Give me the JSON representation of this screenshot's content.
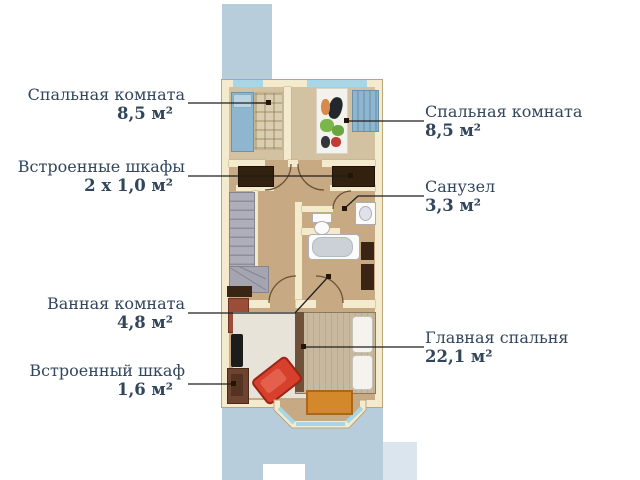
{
  "diagram_type": "apartment-floor-plan",
  "language": "ru",
  "palette": {
    "label_text": "#31455c",
    "wall": "#f4ebce",
    "floor": "#c7aa83",
    "roof": "#b7cddc",
    "glass": "#a6d6e8",
    "closet_dark": "#33210f",
    "armchair_red": "#d6402c",
    "table_orange": "#d4882c",
    "leader_line": "#1f1f1f"
  },
  "labels": {
    "left": [
      {
        "name": "Спальная комната",
        "value": "8,5 м²"
      },
      {
        "name": "Встроенные шкафы",
        "value": "2 х 1,0 м²"
      },
      {
        "name": "Ванная комната",
        "value": "4,8 м²"
      },
      {
        "name": "Встроенный шкаф",
        "value": "1,6 м²"
      }
    ],
    "right": [
      {
        "name": "Спальная комната",
        "value": "8,5 м²"
      },
      {
        "name": "Санузел",
        "value": "3,3 м²"
      },
      {
        "name": "Главная спальня",
        "value": "22,1 м²"
      }
    ]
  },
  "rooms": [
    {
      "label": "Спальная комната",
      "area": "8,5 м²"
    },
    {
      "label": "Спальная комната",
      "area": "8,5 м²"
    },
    {
      "label": "Встроенные шкафы",
      "area": "2 х 1,0 м²"
    },
    {
      "label": "Санузел",
      "area": "3,3 м²"
    },
    {
      "label": "Ванная комната",
      "area": "4,8 м²"
    },
    {
      "label": "Главная спальня",
      "area": "22,1 м²"
    },
    {
      "label": "Встроенный шкаф",
      "area": "1,6 м²"
    }
  ]
}
